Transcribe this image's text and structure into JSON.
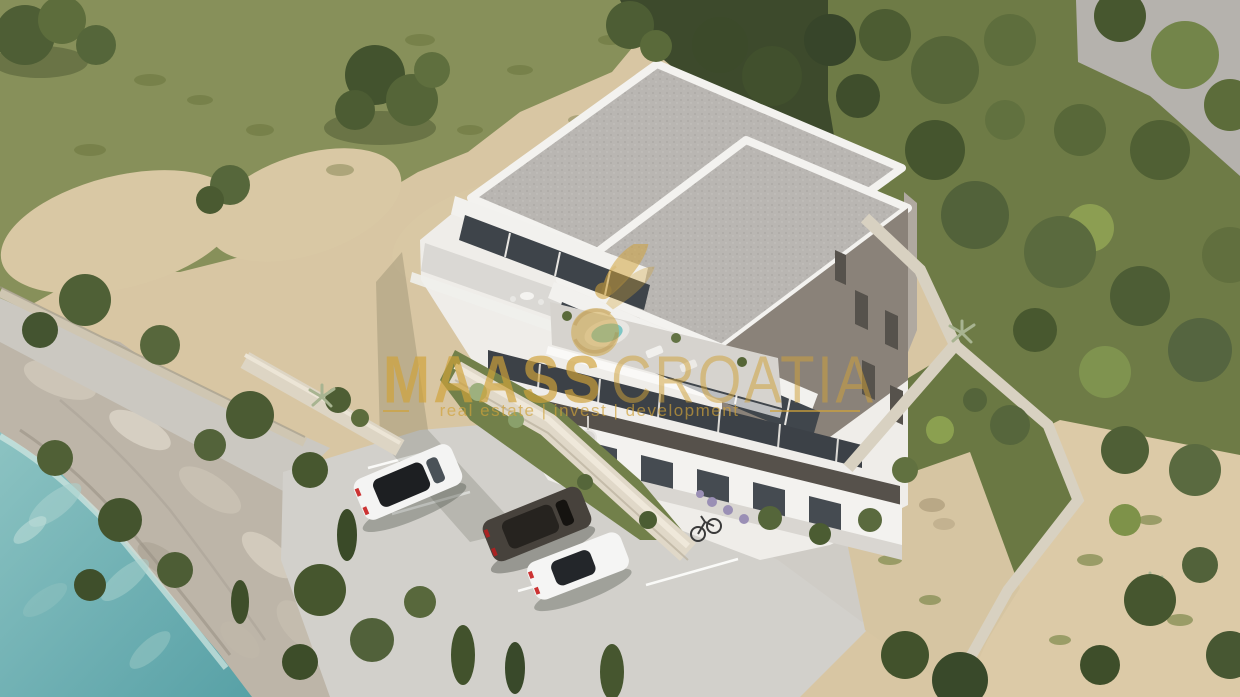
{
  "watermark": {
    "logo_icon": "bee-logo-icon",
    "brand": "MAASS",
    "brand_region": "CROATIA",
    "tagline": "real estate | invest | development",
    "gold_color": "#D0A23A"
  },
  "scene": {
    "type": "aerial-3d-architectural-render",
    "palette": {
      "sea": "#6FB0B3",
      "sea_foam": "#B7DBD7",
      "sand": "#DCC9A6",
      "grass_field": "#87905A",
      "hillside_grass": "#6E7B46",
      "tree_dark": "#46562E",
      "tree_mid": "#5A6A3C",
      "tree_light": "#8C9E52",
      "rock": "#C2BAAC",
      "parking_concrete": "#D2D0CB",
      "roof_concrete": "#B9B6B2",
      "parapet_white": "#F3F2EF",
      "facade_white": "#EFEDE9",
      "facade_dark": "#8A8279",
      "balcony_fascia": "#56514B",
      "window_glass": "#3E444A",
      "stone_wall": "#DDD5C4",
      "neighbor_plane": "#B5B2AD",
      "jacuzzi_water": "#7EC6C4"
    },
    "objects": [
      "apartment-building",
      "flat-roofs",
      "roof-terrace-jacuzzi",
      "balconies",
      "stone-retaining-walls",
      "parking-lot",
      "white-suv",
      "dark-suv",
      "white-sedan",
      "bicycle",
      "promenade-path",
      "rocky-shoreline",
      "sea",
      "beach-scrub",
      "grass-field",
      "hillside-trees",
      "neighbor-plot-plane"
    ]
  }
}
